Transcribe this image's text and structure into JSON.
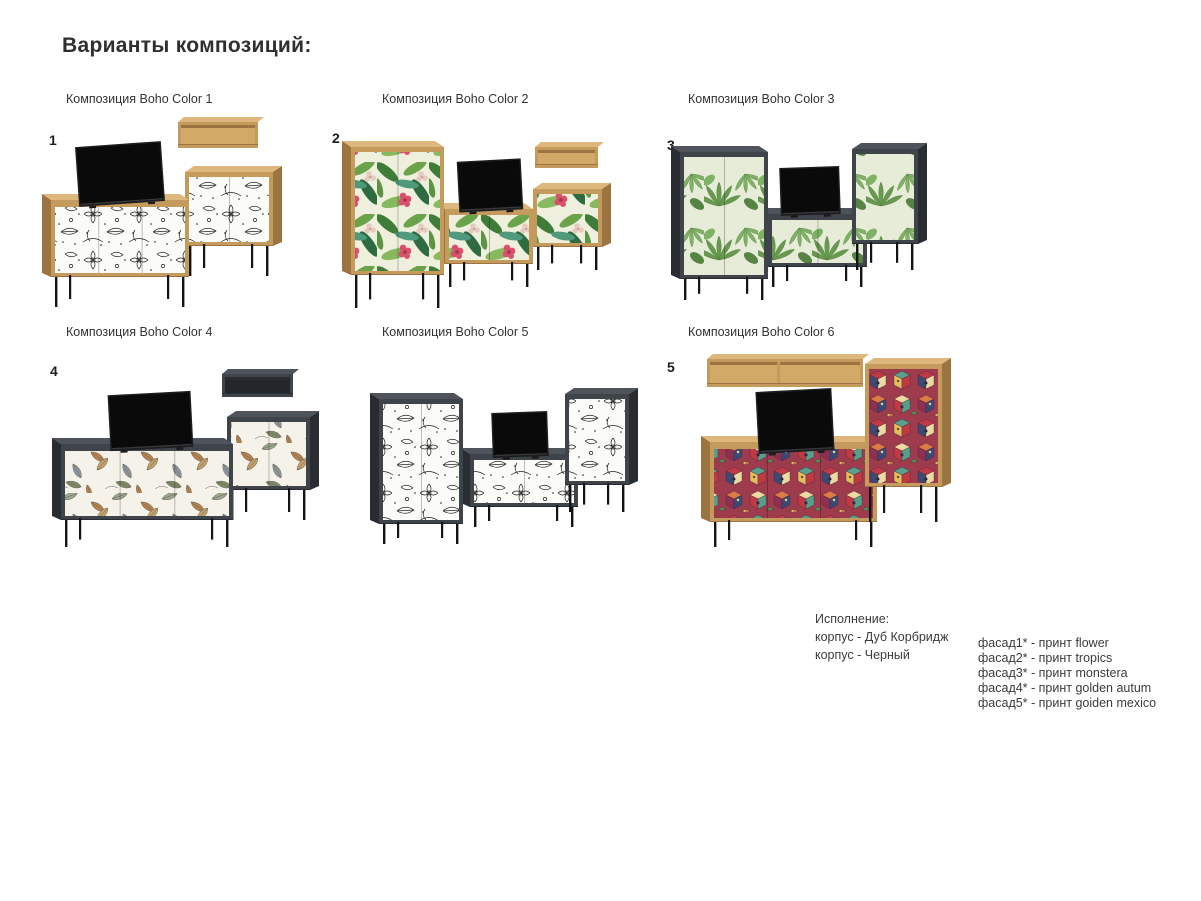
{
  "page": {
    "title": "Варианты композиций:"
  },
  "compositions": [
    {
      "number": "1",
      "label": "Композиция Boho Color 1",
      "print": "flower",
      "body": "Дуб Корбридж"
    },
    {
      "number": "2",
      "label": "Композиция Boho Color 2",
      "print": "tropics",
      "body": "Дуб Корбридж"
    },
    {
      "number": "3",
      "label": "Композиция Boho Color 3",
      "print": "monstera",
      "body": "Черный"
    },
    {
      "number": "4",
      "label": "Композиция Boho Color 4",
      "print": "golden autum",
      "body": "Черный"
    },
    {
      "number": "",
      "label": "Композиция Boho Color 5",
      "print": "flower",
      "body": "Черный"
    },
    {
      "number": "5",
      "label": "Композиция Boho Color 6",
      "print": "goiden mexico",
      "body": "Дуб Корбридж"
    }
  ],
  "legend": {
    "title": "Исполнение:",
    "body_lines": [
      "корпус - Дуб Корбридж",
      "корпус - Черный"
    ],
    "facade_lines": [
      "фасад1* - принт flower",
      "фасад2* - принт tropics",
      "фасад3* - принт monstera",
      "фасад4* - принт golden autum",
      "фасад5* - принт goiden mexico"
    ]
  },
  "colors": {
    "oak_front": "#c49a5d",
    "oak_side": "#9c7441",
    "oak_top": "#ddb77c",
    "oak_interior": "#d3a968",
    "dark_front": "#3f434a",
    "dark_side": "#292c31",
    "dark_top": "#4f545c",
    "dark_interior": "#23262b",
    "leg": "#131416",
    "tv_frame": "#1d1e20",
    "tv_screen": "#0a0a0b",
    "text": "#333333",
    "title": "#2f2f2f"
  }
}
